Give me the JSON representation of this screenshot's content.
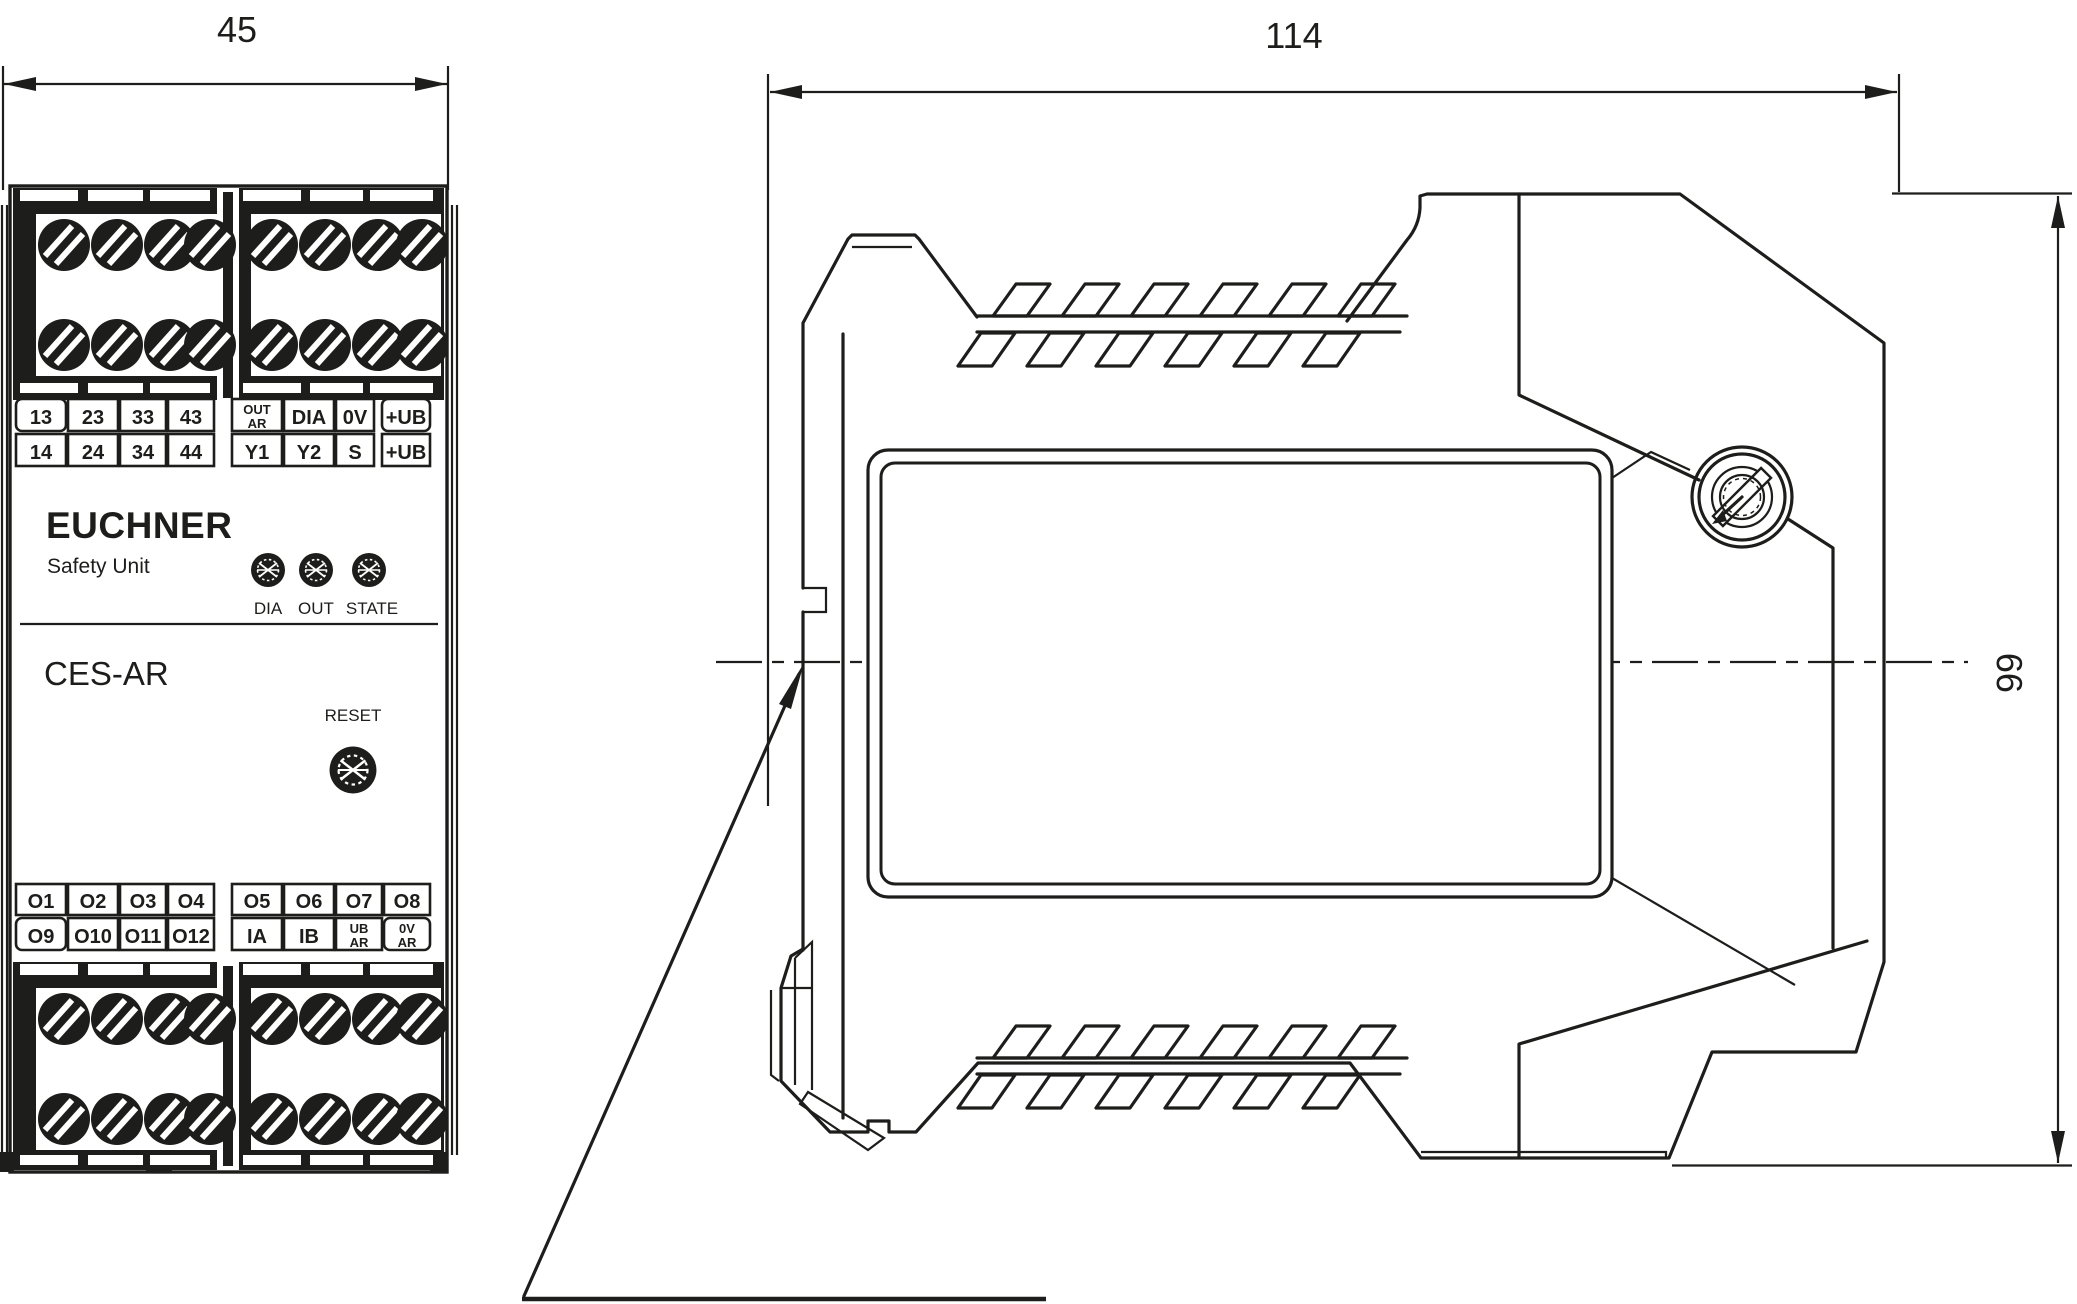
{
  "drawing": {
    "kind": "technical dimension drawing",
    "line_color": "#1d1d1b",
    "background": "#ffffff"
  },
  "dimensions": {
    "width": "45",
    "depth": "114",
    "height": "99"
  },
  "branding": {
    "manufacturer": "EUCHNER",
    "subtitle": "Safety Unit",
    "model": "CES-AR"
  },
  "controls": {
    "reset_label": "RESET",
    "led_labels": [
      "DIA",
      "OUT",
      "STATE"
    ]
  },
  "terminals": {
    "top": {
      "row1_left": [
        "13",
        "23",
        "33",
        "43"
      ],
      "row1_right": [
        [
          "OUT",
          "AR"
        ],
        [
          "DIA",
          ""
        ],
        [
          "0V",
          ""
        ],
        [
          "+UB",
          ""
        ]
      ],
      "row2_left": [
        "14",
        "24",
        "34",
        "44"
      ],
      "row2_right": [
        "Y1",
        "Y2",
        "S",
        "+UB"
      ]
    },
    "bottom": {
      "row1_left": [
        "O1",
        "O2",
        "O3",
        "O4"
      ],
      "row1_right": [
        "O5",
        "O6",
        "O7",
        "O8"
      ],
      "row2_left": [
        "O9",
        "O10",
        "O11",
        "O12"
      ],
      "row2_right": [
        [
          "IA",
          ""
        ],
        [
          "IB",
          ""
        ],
        [
          "UB",
          "AR"
        ],
        [
          "0V",
          "AR"
        ]
      ]
    }
  }
}
